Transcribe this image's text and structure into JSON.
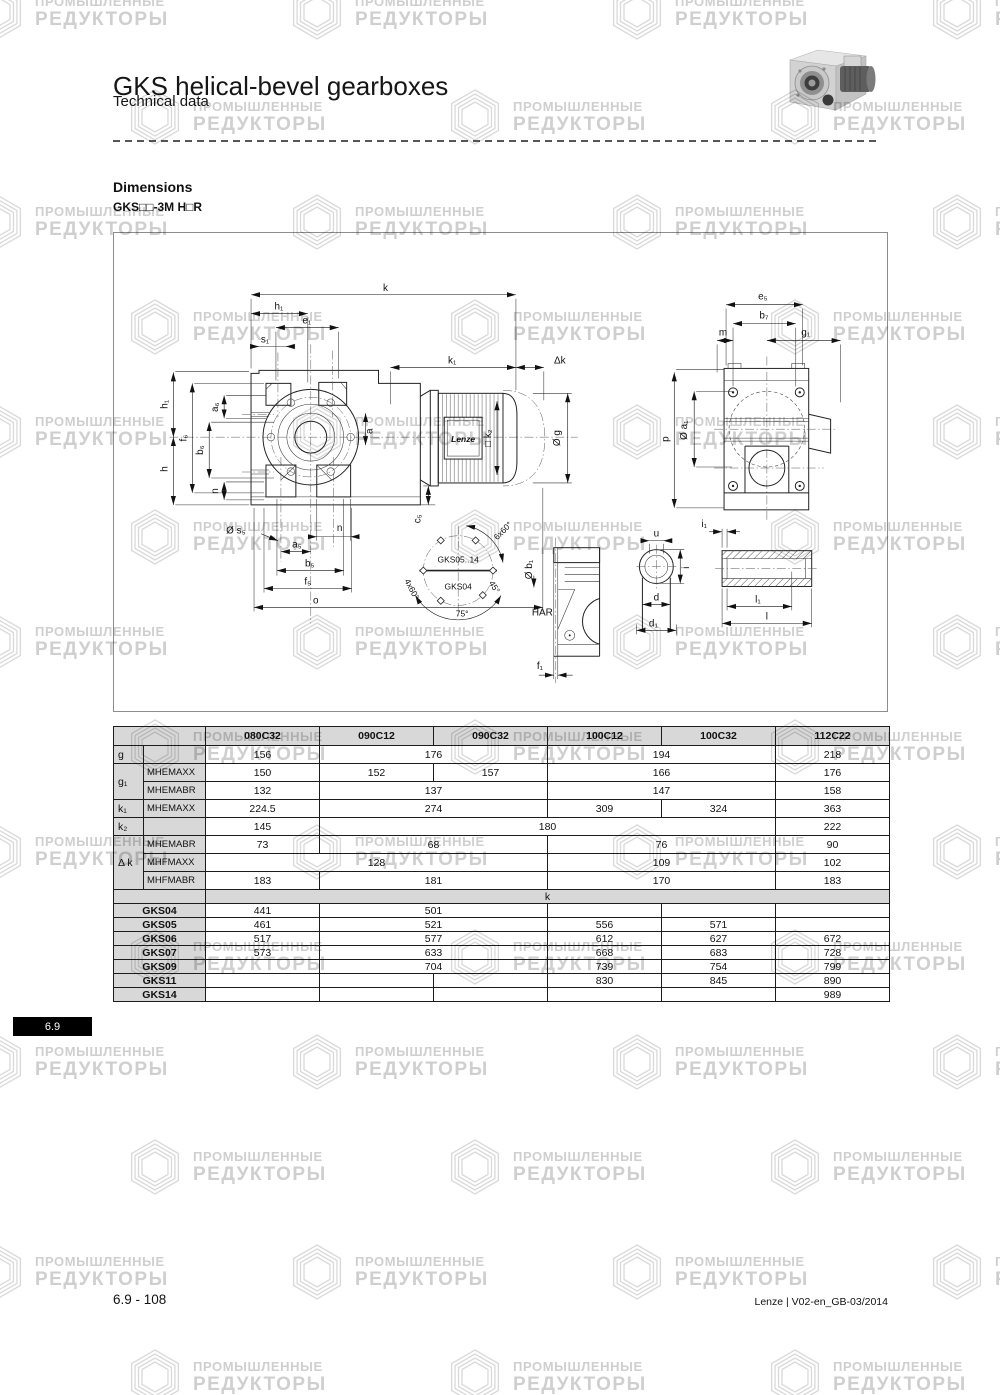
{
  "page": {
    "title": "GKS helical-bevel gearboxes",
    "subtitle": "Technical data",
    "section_heading": "Dimensions",
    "variant_label": "GKS□□-3M H□R",
    "side_tab": "6.9",
    "footer_left": "6.9 - 108",
    "footer_right": "Lenze | V02-en_GB-03/2014"
  },
  "watermark": {
    "line1": "ПРОМЫШЛЕННЫЕ",
    "line2": "РЕДУКТОРЫ"
  },
  "drawing": {
    "brand": "Lenze",
    "labels": {
      "k": "k",
      "h1": "h₁",
      "e1": "e₁",
      "s1": "s₁",
      "k1": "k₁",
      "dk": "Δk",
      "f6": "f₆",
      "b6": "b₆",
      "a6": "a₆",
      "h": "h",
      "n": "n",
      "a": "a",
      "phi_s5": "Ø s₅",
      "a5": "a₅",
      "b5": "b₅",
      "f5": "f₅",
      "o": "o",
      "c5": "c₅",
      "k2": "□ k₂",
      "phi_g": "Ø g",
      "gks0514": "GKS05..14",
      "gks04": "GKS04",
      "x660": "6x60°",
      "x460": "4x60°",
      "deg45": "45°",
      "deg75": "75°",
      "har": "HAR",
      "phi_b1": "Ø b₁",
      "f1": "f₁",
      "u": "u",
      "i": "i",
      "d": "d",
      "d1": "d₁",
      "i1": "i₁",
      "l1": "l₁",
      "l": "l",
      "e5": "e₅",
      "b7": "b₇",
      "m": "m",
      "g1": "g₁",
      "p": "p",
      "phi_a1": "Ø a₁"
    }
  },
  "table": {
    "columns": [
      "080C32",
      "090C12",
      "090C32",
      "100C12",
      "100C32",
      "112C22"
    ],
    "dim_rows": [
      {
        "l1": "g",
        "l1_rs": 1,
        "l2": "",
        "cells": [
          [
            "156",
            1
          ],
          [
            "176",
            2
          ],
          [
            "194",
            2
          ],
          [
            "218",
            1
          ]
        ]
      },
      {
        "l1": "g₁",
        "l1_rs": 2,
        "l2": "MHEMAXX",
        "cells": [
          [
            "150",
            1
          ],
          [
            "152",
            1
          ],
          [
            "157",
            1
          ],
          [
            "166",
            2
          ],
          [
            "176",
            1
          ]
        ]
      },
      {
        "l2": "MHEMABR",
        "cells": [
          [
            "132",
            1
          ],
          [
            "137",
            2
          ],
          [
            "147",
            2
          ],
          [
            "158",
            1
          ]
        ]
      },
      {
        "l1": "k₁",
        "l1_rs": 1,
        "l2": "MHEMAXX",
        "cells": [
          [
            "224.5",
            1
          ],
          [
            "274",
            2
          ],
          [
            "309",
            1
          ],
          [
            "324",
            1
          ],
          [
            "363",
            1
          ]
        ]
      },
      {
        "l1": "k₂",
        "l1_rs": 1,
        "l2": "",
        "cells": [
          [
            "145",
            1
          ],
          [
            "180",
            4
          ],
          [
            "222",
            1
          ]
        ]
      },
      {
        "l1": "Δ k",
        "l1_rs": 3,
        "l2": "MHEMABR",
        "cells": [
          [
            "73",
            1
          ],
          [
            "68",
            2
          ],
          [
            "76",
            2
          ],
          [
            "90",
            1
          ]
        ]
      },
      {
        "l2": "MHFMAXX",
        "cells": [
          [
            "128",
            3
          ],
          [
            "109",
            2
          ],
          [
            "102",
            1
          ]
        ]
      },
      {
        "l2": "MHFMABR",
        "cells": [
          [
            "183",
            1
          ],
          [
            "181",
            2
          ],
          [
            "170",
            2
          ],
          [
            "183",
            1
          ]
        ]
      }
    ],
    "section_label": "k",
    "gks_rows": [
      {
        "label": "GKS04",
        "cells": [
          [
            "441",
            1
          ],
          [
            "501",
            2
          ],
          [
            "",
            1
          ],
          [
            "",
            1
          ],
          [
            "",
            1
          ]
        ]
      },
      {
        "label": "GKS05",
        "cells": [
          [
            "461",
            1
          ],
          [
            "521",
            2
          ],
          [
            "556",
            1
          ],
          [
            "571",
            1
          ],
          [
            "",
            1
          ]
        ]
      },
      {
        "label": "GKS06",
        "cells": [
          [
            "517",
            1
          ],
          [
            "577",
            2
          ],
          [
            "612",
            1
          ],
          [
            "627",
            1
          ],
          [
            "672",
            1
          ]
        ]
      },
      {
        "label": "GKS07",
        "cells": [
          [
            "573",
            1
          ],
          [
            "633",
            2
          ],
          [
            "668",
            1
          ],
          [
            "683",
            1
          ],
          [
            "728",
            1
          ]
        ]
      },
      {
        "label": "GKS09",
        "cells": [
          [
            "",
            1
          ],
          [
            "704",
            2
          ],
          [
            "739",
            1
          ],
          [
            "754",
            1
          ],
          [
            "799",
            1
          ]
        ]
      },
      {
        "label": "GKS11",
        "cells": [
          [
            "",
            1
          ],
          [
            "",
            1
          ],
          [
            "",
            1
          ],
          [
            "830",
            1
          ],
          [
            "845",
            1
          ],
          [
            "890",
            1
          ]
        ]
      },
      {
        "label": "GKS14",
        "cells": [
          [
            "",
            1
          ],
          [
            "",
            1
          ],
          [
            "",
            1
          ],
          [
            "",
            1
          ],
          [
            "",
            1
          ],
          [
            "989",
            1
          ]
        ]
      }
    ]
  }
}
